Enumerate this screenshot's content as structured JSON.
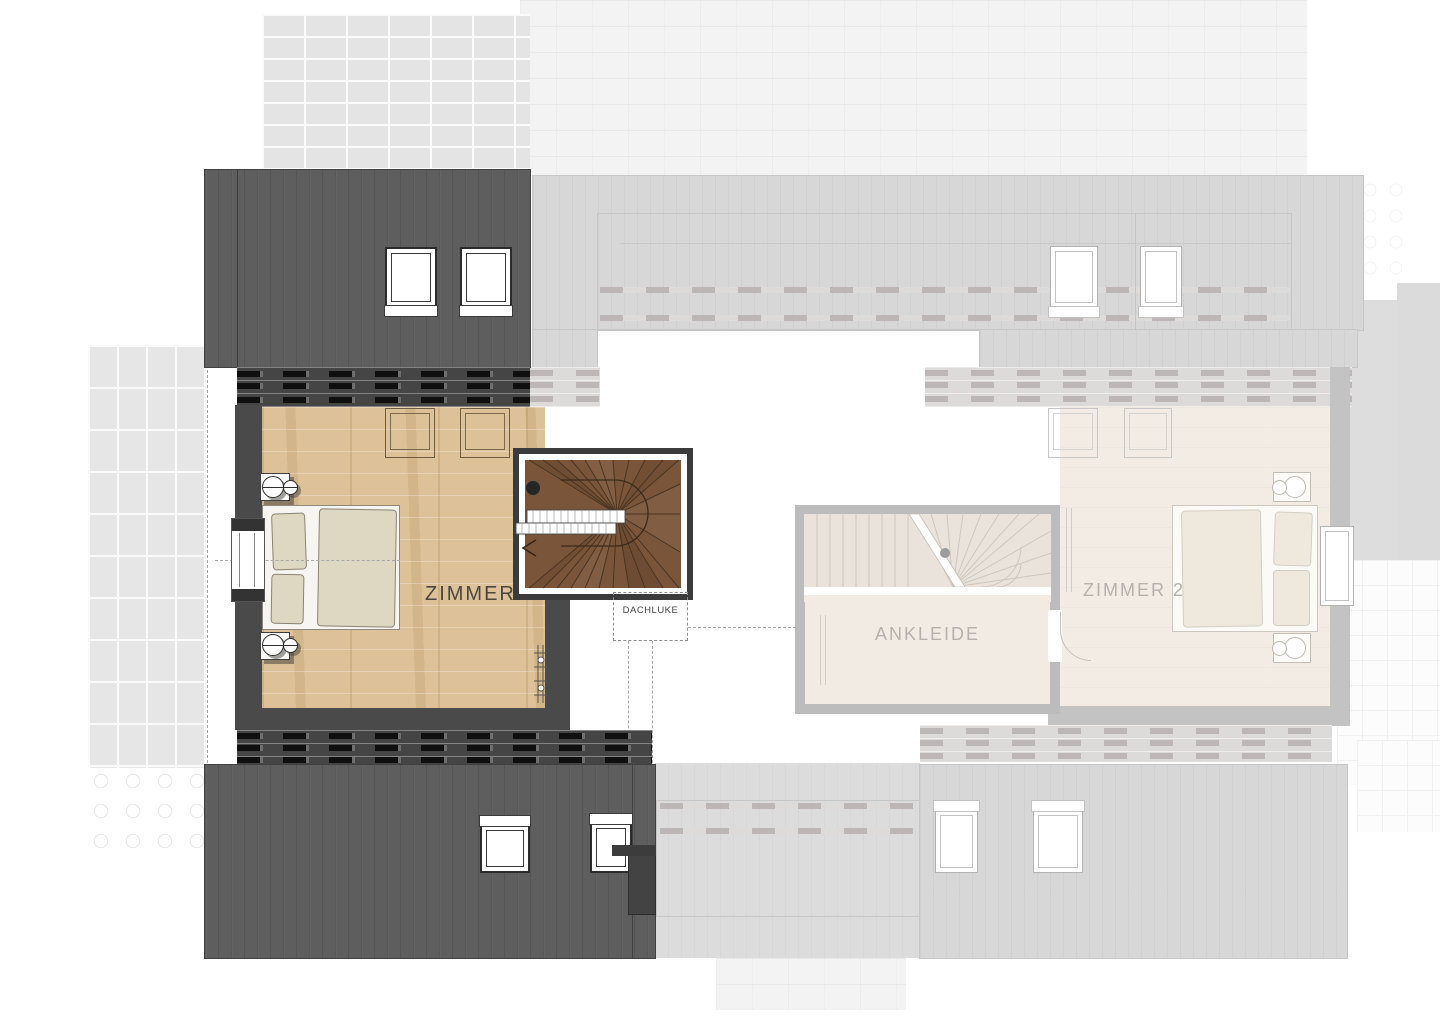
{
  "plan": {
    "rooms": {
      "zimmer": {
        "label": "ZIMMER"
      },
      "dachluke": {
        "label": "DACHLUKE"
      },
      "ankleide": {
        "label": "ANKLEIDE"
      },
      "zimmer2": {
        "label": "ZIMMER 2"
      }
    },
    "palette": {
      "roof_dark": "#5e5e5e",
      "wall_dark": "#454545",
      "floor_wood": "#ddc198",
      "stair_wood": "#7b5539",
      "neighbor_roof": "#d7d7d7",
      "neighbor_wall": "#bcbcbc",
      "neighbor_floor": "#f2ece4",
      "label_active": "#4b463e",
      "label_faded": "#b7b1ab",
      "paving": "#e6e6e6",
      "brick": "#e4e4e4"
    }
  }
}
